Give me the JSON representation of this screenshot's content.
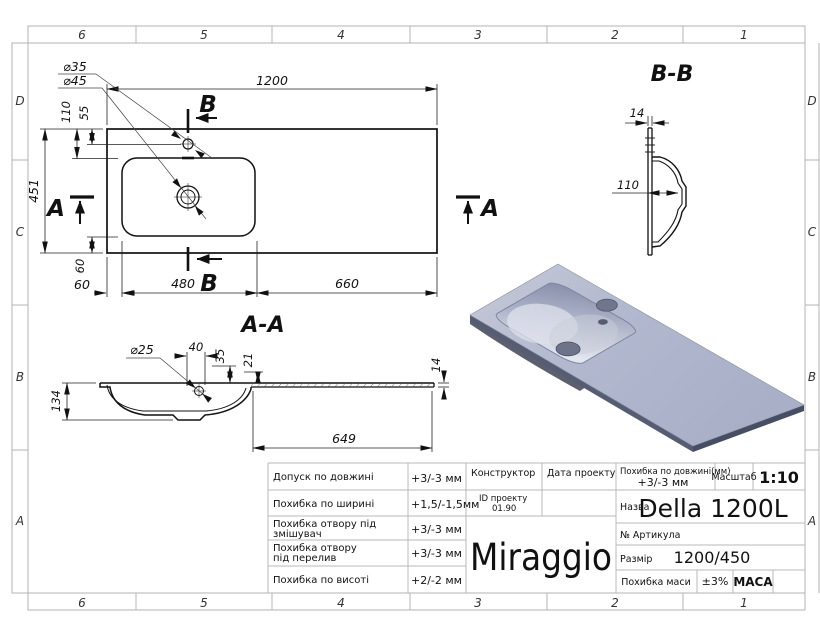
{
  "frame": {
    "cols": [
      "6",
      "5",
      "4",
      "3",
      "2",
      "1"
    ],
    "rows": [
      "D",
      "C",
      "B",
      "A"
    ]
  },
  "plan": {
    "dim_length": "1200",
    "dim_width": "451",
    "dim_hole_faucet": "⌀35",
    "dim_hole_drain": "⌀45",
    "dim_110": "110",
    "dim_55": "55",
    "dim_60_vert": "60",
    "dim_60": "60",
    "dim_480": "480",
    "dim_660": "660",
    "marker_a": "A",
    "marker_b": "B"
  },
  "section_bb": {
    "title": "B-B",
    "dim_thickness": "14",
    "dim_depth": "110"
  },
  "section_aa": {
    "title": "A-A",
    "dim_hole": "⌀25",
    "dim_40": "40",
    "dim_35": "35",
    "dim_21": "21",
    "dim_14": "14",
    "dim_134": "134",
    "dim_649": "649"
  },
  "titleblock": {
    "tolerances": [
      {
        "label": "Допуск по довжині",
        "value": "+3/-3 мм"
      },
      {
        "label": "Похибка по ширині",
        "value": "+1,5/-1,5мм"
      },
      {
        "label": "Похибка отвору під",
        "label2": "змішувач",
        "value": "+3/-3 мм"
      },
      {
        "label": "Похибка отвору",
        "label2": "під перелив",
        "value": "+3/-3 мм"
      },
      {
        "label": "Похибка по висоті",
        "value": "+2/-2 мм"
      }
    ],
    "constructor_label": "Конструктор",
    "date_label": "Дата проекту",
    "id_label": "ID проекту",
    "id_value": "01.90",
    "length_tol_label": "Похибка по довжині(мм)",
    "length_tol_value": "+3/-3 мм",
    "scale_label": "Масштаб",
    "scale_value": "1:10",
    "name_label": "Назва",
    "name_value": "Della 1200L",
    "article_label": "№ Артикула",
    "size_label": "Размір",
    "size_value": "1200/450",
    "mass_tol_label": "Похибка маси",
    "mass_tol_value": "±3%",
    "mass_label": "МАСА",
    "brand": "Miraggio"
  },
  "colors": {
    "drawing_line": "#111111",
    "grid_line": "#b9b9b9",
    "render_top": "#b2b8ce",
    "render_highlight": "#e4e7f0",
    "render_shadow": "#868da8",
    "render_edge": "#474d63"
  }
}
